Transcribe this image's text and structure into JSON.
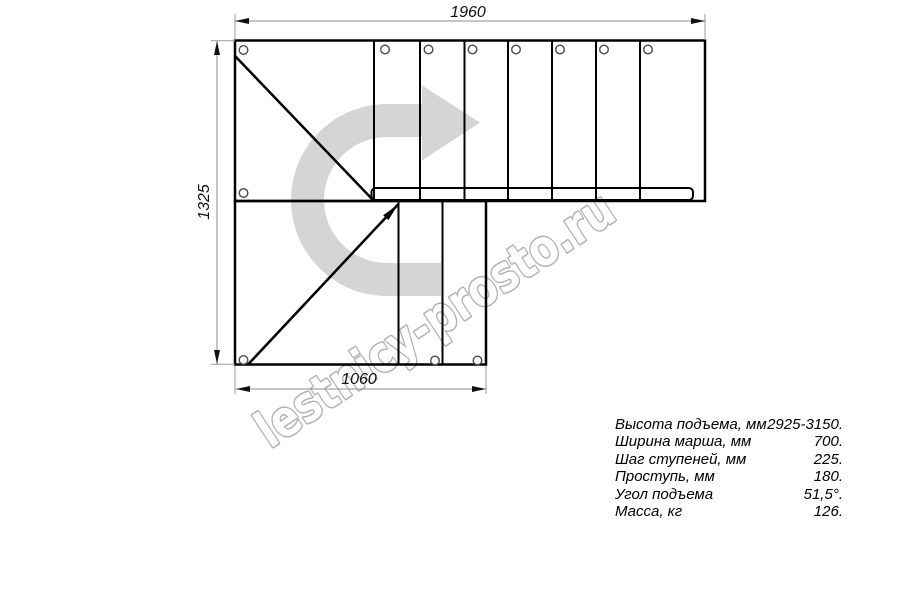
{
  "drawing": {
    "dimensions": {
      "top": "1960",
      "left": "1325",
      "bottom": "1060"
    },
    "watermark": {
      "text": "lestnicy-prosto.ru"
    },
    "specs": {
      "rows": [
        {
          "label": "Высота подъема, мм",
          "value": "2925-3150."
        },
        {
          "label": "Ширина марша, мм",
          "value": "700."
        },
        {
          "label": "Шаг ступеней, мм",
          "value": "225."
        },
        {
          "label": "Проступь, мм",
          "value": "180."
        },
        {
          "label": "Угол подъема",
          "value": "51,5°."
        },
        {
          "label": "Масса, кг",
          "value": "126."
        }
      ]
    },
    "colors": {
      "line": "#000000",
      "dimension_line": "#8c8c8c",
      "watermark_fill": "#d4d5d6",
      "watermark_outline": "#b2b2b2"
    }
  }
}
